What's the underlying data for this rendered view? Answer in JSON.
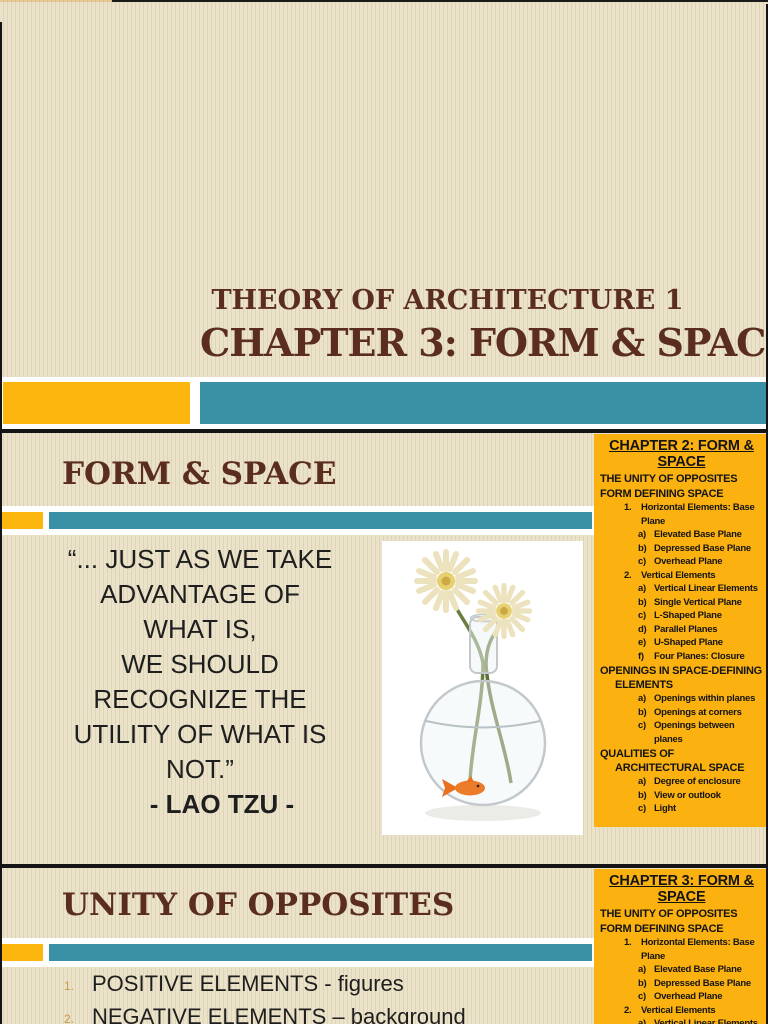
{
  "document": {
    "type": "presentation-page",
    "colors": {
      "background_beige": "#e7dfc6",
      "accent_orange": "#fdb60d",
      "accent_teal": "#3a91a5",
      "sidebar_yellow": "#fbb110",
      "heading_maroon": "#5b2d21",
      "separator_black": "#141414"
    }
  },
  "slide1": {
    "title_line1": "THEORY OF ARCHITECTURE 1",
    "title_line2": "CHAPTER 3: FORM & SPACE"
  },
  "slide2": {
    "heading": "FORM & SPACE",
    "quote_lines": [
      "“... JUST AS WE TAKE",
      "ADVANTAGE OF",
      "WHAT IS,",
      "WE SHOULD",
      "RECOGNIZE THE",
      "UTILITY OF WHAT IS",
      "NOT.”"
    ],
    "attribution": "- LAO TZU -",
    "photo_description": "glass vase with two white gerbera daisies and a goldfish",
    "sidebar": {
      "title_line1": "CHAPTER 2: FORM &",
      "title_line2": "SPACE",
      "items": [
        {
          "level": 0,
          "num": "",
          "text": "THE UNITY OF OPPOSITES"
        },
        {
          "level": 0,
          "num": "",
          "text": "FORM DEFINING SPACE"
        },
        {
          "level": 1,
          "num": "1.",
          "text": "Horizontal Elements: Base Plane"
        },
        {
          "level": 2,
          "num": "a)",
          "text": "Elevated Base Plane"
        },
        {
          "level": 2,
          "num": "b)",
          "text": "Depressed Base Plane"
        },
        {
          "level": 2,
          "num": "c)",
          "text": "Overhead Plane"
        },
        {
          "level": 1,
          "num": "2.",
          "text": "Vertical Elements"
        },
        {
          "level": 2,
          "num": "a)",
          "text": "Vertical Linear Elements"
        },
        {
          "level": 2,
          "num": "b)",
          "text": "Single Vertical Plane"
        },
        {
          "level": 2,
          "num": "c)",
          "text": "L-Shaped Plane"
        },
        {
          "level": 2,
          "num": "d)",
          "text": "Parallel Planes"
        },
        {
          "level": 2,
          "num": "e)",
          "text": "U-Shaped Plane"
        },
        {
          "level": 2,
          "num": "f)",
          "text": "Four Planes: Closure"
        },
        {
          "level": 0,
          "num": "",
          "text": "OPENINGS IN SPACE-DEFINING ELEMENTS"
        },
        {
          "level": 2,
          "num": "a)",
          "text": "Openings within planes"
        },
        {
          "level": 2,
          "num": "b)",
          "text": "Openings at corners"
        },
        {
          "level": 2,
          "num": "c)",
          "text": "Openings between planes"
        },
        {
          "level": 0,
          "num": "",
          "text": "QUALITIES OF ARCHITECTURAL SPACE"
        },
        {
          "level": 2,
          "num": "a)",
          "text": "Degree of enclosure"
        },
        {
          "level": 2,
          "num": "b)",
          "text": "View or outlook"
        },
        {
          "level": 2,
          "num": "c)",
          "text": "Light"
        }
      ]
    }
  },
  "slide3": {
    "heading": "UNITY OF OPPOSITES",
    "list": [
      {
        "num": "1.",
        "text": "POSITIVE ELEMENTS - figures"
      },
      {
        "num": "2.",
        "text": "NEGATIVE ELEMENTS – background"
      }
    ],
    "sidebar": {
      "title_line1": "CHAPTER 3: FORM &",
      "title_line2": "SPACE",
      "items": [
        {
          "level": 0,
          "num": "",
          "text": "THE UNITY OF OPPOSITES"
        },
        {
          "level": 0,
          "num": "",
          "text": "FORM DEFINING SPACE"
        },
        {
          "level": 1,
          "num": "1.",
          "text": "Horizontal Elements: Base Plane"
        },
        {
          "level": 2,
          "num": "a)",
          "text": "Elevated Base Plane"
        },
        {
          "level": 2,
          "num": "b)",
          "text": "Depressed Base Plane"
        },
        {
          "level": 2,
          "num": "c)",
          "text": "Overhead Plane"
        },
        {
          "level": 1,
          "num": "2.",
          "text": "Vertical Elements"
        },
        {
          "level": 2,
          "num": "a)",
          "text": "Vertical Linear Elements"
        }
      ]
    }
  }
}
